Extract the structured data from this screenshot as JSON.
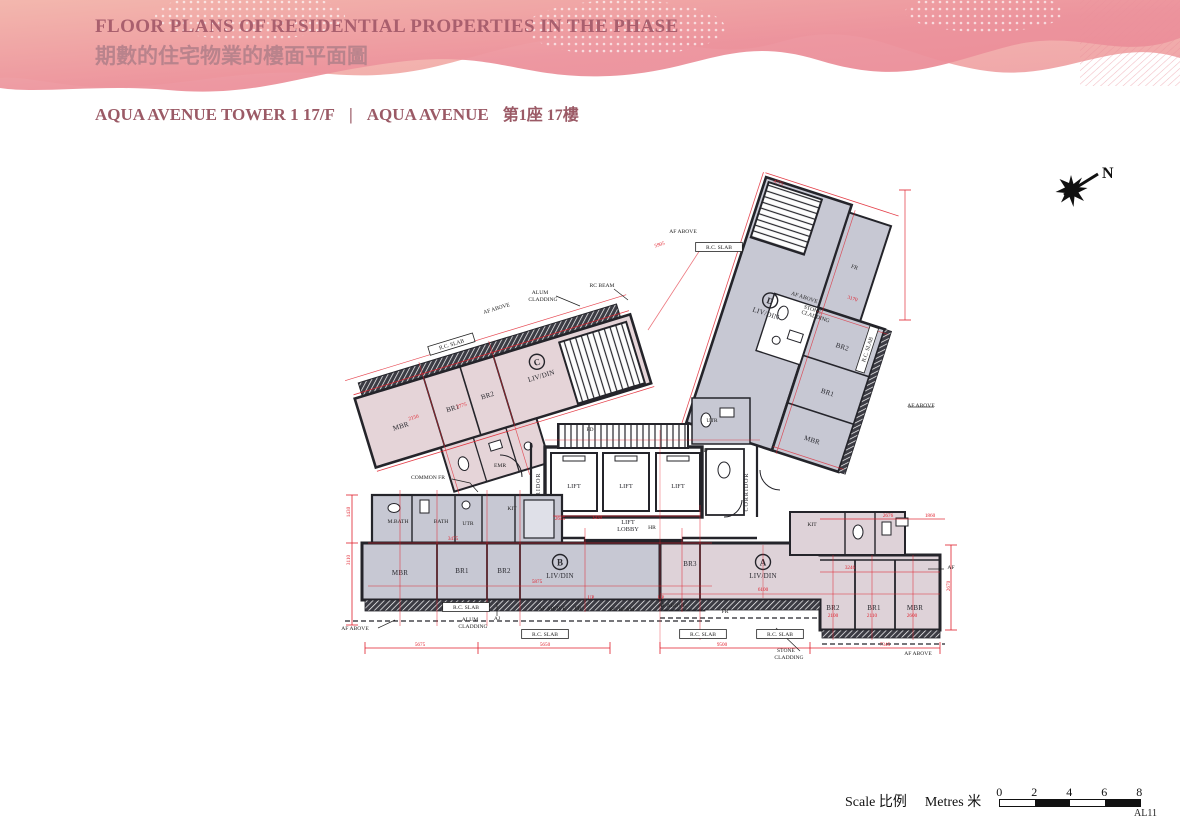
{
  "header": {
    "title_en": "FLOOR PLANS OF RESIDENTIAL PROPERTIES IN THE PHASE",
    "title_zh": "期數的住宅物業的樓面平面圖"
  },
  "subtitle": {
    "left": "AQUA AVENUE TOWER 1  17/F",
    "divider": "|",
    "right_en": "AQUA AVENUE",
    "right_zh": "第1座 17樓"
  },
  "compass": {
    "label": "N"
  },
  "core": {
    "lift1": "LIFT",
    "lift2": "LIFT",
    "lift3": "LIFT",
    "lobby_line1": "LIFT",
    "lobby_line2": "LOBBY",
    "corridor_left": "CORRIDOR",
    "corridor_right": "CORRIDOR"
  },
  "units": {
    "a": {
      "id": "A",
      "living": "LIV/DIN",
      "br3": "BR3",
      "br2": "BR2",
      "br1": "BR1",
      "mbr": "MBR",
      "kit": "KIT"
    },
    "b": {
      "id": "B",
      "living": "LIV/DIN",
      "mbr": "MBR",
      "br1": "BR1",
      "br2": "BR2",
      "mbath": "M.BATH",
      "bath": "BATH",
      "utr": "UTR",
      "kit": "KIT"
    },
    "c": {
      "id": "C",
      "living": "LIV/DIN",
      "mbr": "MBR",
      "br1": "BR1",
      "br2": "BR2"
    },
    "d": {
      "id": "D",
      "living": "LIV/DIN",
      "mbr": "MBR",
      "br1": "BR1",
      "br2": "BR2",
      "fr": "FR"
    }
  },
  "callouts": [
    {
      "t": "R.C. SLAB",
      "x": 452,
      "y": 346,
      "r": -17,
      "box": true
    },
    {
      "t": "AF ABOVE",
      "x": 497,
      "y": 310,
      "r": -17
    },
    {
      "t": "ALUM",
      "x": 540,
      "y": 294
    },
    {
      "t": "CLADDING",
      "x": 543,
      "y": 301
    },
    {
      "t": "RC BEAM",
      "x": 602,
      "y": 287
    },
    {
      "t": "AF ABOVE",
      "x": 683,
      "y": 233
    },
    {
      "t": "R.C. SLAB",
      "x": 719,
      "y": 249,
      "box": true
    },
    {
      "t": "AF ABOVE",
      "x": 804,
      "y": 299,
      "r": 18
    },
    {
      "t": "STONE",
      "x": 812,
      "y": 311,
      "r": 18
    },
    {
      "t": "CLADDING",
      "x": 815,
      "y": 318,
      "r": 18
    },
    {
      "t": "R.C. SLAB",
      "x": 869,
      "y": 350,
      "r": -72,
      "box": true
    },
    {
      "t": "AF ABOVE",
      "x": 921,
      "y": 407
    },
    {
      "t": "COMMON FR",
      "x": 428,
      "y": 479
    },
    {
      "t": "EMR",
      "x": 500,
      "y": 467
    },
    {
      "t": "UTR",
      "x": 712,
      "y": 422
    },
    {
      "t": "PD",
      "x": 704,
      "y": 452
    },
    {
      "t": "FD",
      "x": 590,
      "y": 431
    },
    {
      "t": "HR",
      "x": 652,
      "y": 529
    },
    {
      "t": "AF ABOVE",
      "x": 355,
      "y": 630
    },
    {
      "t": "R.C. SLAB",
      "x": 466,
      "y": 609,
      "box": true
    },
    {
      "t": "ALUM",
      "x": 470,
      "y": 621
    },
    {
      "t": "CLADDING",
      "x": 473,
      "y": 628
    },
    {
      "t": "AJ",
      "x": 497,
      "y": 620
    },
    {
      "t": "AF ABOVE",
      "x": 552,
      "y": 610
    },
    {
      "t": "FR",
      "x": 578,
      "y": 610
    },
    {
      "t": "R.C. SLAB",
      "x": 545,
      "y": 636,
      "box": true
    },
    {
      "t": "RC BEAM",
      "x": 622,
      "y": 611
    },
    {
      "t": "AF ABOVE",
      "x": 672,
      "y": 607
    },
    {
      "t": "FR",
      "x": 725,
      "y": 613
    },
    {
      "t": "R.C. SLAB",
      "x": 703,
      "y": 636,
      "box": true
    },
    {
      "t": "R.C. SLAB",
      "x": 780,
      "y": 636,
      "box": true
    },
    {
      "t": "STONE",
      "x": 786,
      "y": 652
    },
    {
      "t": "CLADDING",
      "x": 789,
      "y": 659
    },
    {
      "t": "AF ABOVE",
      "x": 918,
      "y": 655
    },
    {
      "t": "AF",
      "x": 951,
      "y": 569
    }
  ],
  "dims": [
    {
      "t": "5675",
      "x": 420,
      "y": 646
    },
    {
      "t": "5650",
      "x": 545,
      "y": 646
    },
    {
      "t": "9500",
      "x": 722,
      "y": 646
    },
    {
      "t": "7345",
      "x": 885,
      "y": 646
    },
    {
      "t": "5875",
      "x": 537,
      "y": 583
    },
    {
      "t": "6100",
      "x": 763,
      "y": 591
    },
    {
      "t": "3475",
      "x": 453,
      "y": 540
    },
    {
      "t": "3246",
      "x": 850,
      "y": 569
    },
    {
      "t": "2100",
      "x": 833,
      "y": 617
    },
    {
      "t": "2110",
      "x": 872,
      "y": 617
    },
    {
      "t": "2600",
      "x": 912,
      "y": 617
    },
    {
      "t": "2676",
      "x": 888,
      "y": 517
    },
    {
      "t": "1860",
      "x": 930,
      "y": 517
    },
    {
      "t": "2645",
      "x": 560,
      "y": 520
    },
    {
      "t": "1430",
      "x": 597,
      "y": 519
    },
    {
      "t": "4775",
      "x": 778,
      "y": 184,
      "r": 18
    },
    {
      "t": "5905",
      "x": 660,
      "y": 246,
      "r": -17
    },
    {
      "t": "2150",
      "x": 414,
      "y": 419,
      "r": -17
    },
    {
      "t": "2775",
      "x": 462,
      "y": 407,
      "r": -17
    },
    {
      "t": "3170",
      "x": 852,
      "y": 300,
      "r": 18
    },
    {
      "t": "UP",
      "x": 591,
      "y": 599
    },
    {
      "t": "UP",
      "x": 661,
      "y": 599
    },
    {
      "t": "3110",
      "x": 350,
      "y": 560,
      "r": -90
    },
    {
      "t": "1430",
      "x": 350,
      "y": 512,
      "r": -90
    },
    {
      "t": "2670",
      "x": 950,
      "y": 586,
      "r": -90
    }
  ],
  "scalebar": {
    "scale_en": "Scale",
    "scale_zh": "比例",
    "metres_en": "Metres",
    "metres_zh": "米",
    "ticks": [
      "0",
      "2",
      "4",
      "6",
      "8"
    ]
  },
  "sheet_no": "AL11",
  "colors": {
    "dim_red": "#e01e2a",
    "wall": "#24242a",
    "unit_grey": "#c7c8d3",
    "unit_pink": "#e5d4d8",
    "header_pink": "#ee9ba4",
    "header_peach": "#f6c9b4",
    "title": "#a9616f",
    "subtitle": "#9b5a66"
  }
}
